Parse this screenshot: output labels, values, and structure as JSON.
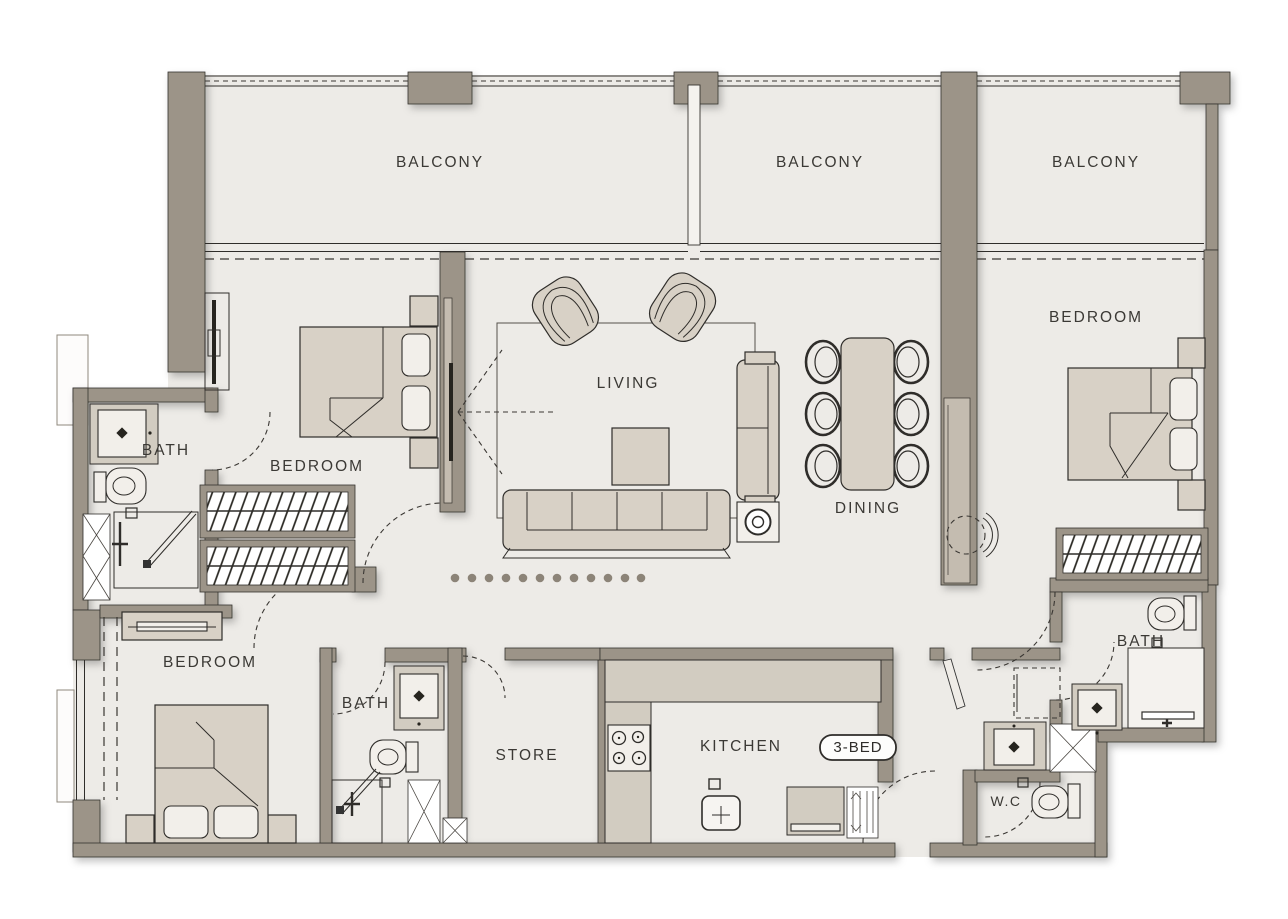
{
  "plan": {
    "type": "apartment-floor-plan",
    "unit_badge": "3-BED",
    "labels": {
      "balcony_1": "BALCONY",
      "balcony_2": "BALCONY",
      "balcony_3": "BALCONY",
      "bedroom_1": "BEDROOM",
      "bedroom_2": "BEDROOM",
      "bedroom_3": "BEDROOM",
      "living": "LIVING",
      "dining": "DINING",
      "bath_1": "BATH",
      "bath_2": "BATH",
      "bath_3": "BATH",
      "store": "STORE",
      "kitchen": "KITCHEN",
      "wc": "W.C"
    },
    "furniture_items": [
      "double-bed",
      "pillow",
      "nightstand",
      "wardrobe",
      "dresser",
      "sofa",
      "loveseat",
      "armchair",
      "coffee-table",
      "side-table",
      "rug",
      "tv",
      "dining-table",
      "dining-chair",
      "kitchen-counter",
      "stove",
      "kitchen-sink",
      "fridge",
      "louver-shaft",
      "washing-machine",
      "bath-sink",
      "toilet",
      "shower",
      "service-shaft",
      "screen-dots",
      "door-swing"
    ],
    "colors": {
      "wall": "#9c9488",
      "floor": "#edebe7",
      "furniture": "#d8d1c6",
      "counter": "#d2ccc1",
      "fixture": "#f2efea",
      "line": "#2f2d2a",
      "background": "#ffffff",
      "dot": "#8c8478"
    }
  }
}
